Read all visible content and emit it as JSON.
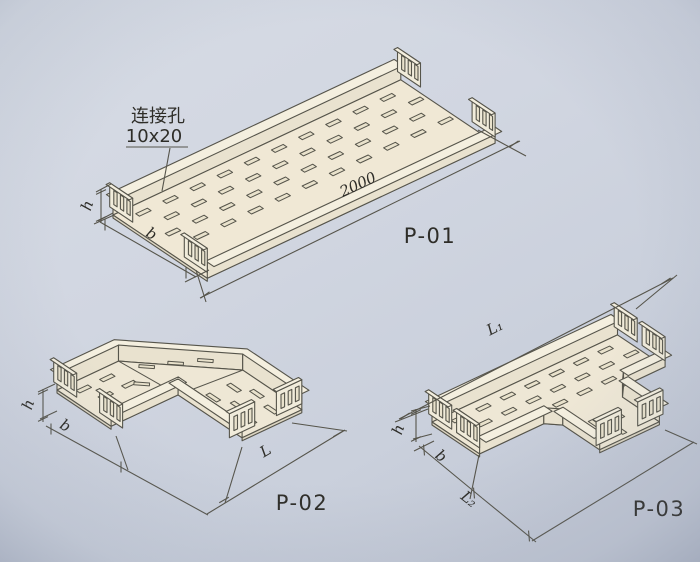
{
  "drawing_type": "cable tray catalog technical drawing",
  "p01": {
    "label": "P-01",
    "note_line1": "连接孔",
    "note_line2": "10x20",
    "dim_h": "h",
    "dim_b": "b",
    "dim_length": "2000"
  },
  "p02": {
    "label": "P-02",
    "dim_h": "h",
    "dim_b": "b",
    "dim_length": "L"
  },
  "p03": {
    "label": "P-03",
    "dim_h": "h",
    "dim_b": "b",
    "dim_l1": "L₁",
    "dim_l2": "L₂"
  },
  "colors": {
    "paper": "#d3d8e2",
    "paper_dark": "#c2c8d6",
    "line": "#56544b",
    "ink": "#2e2d28",
    "tray": "#eee7d5",
    "tray_p01": "#f0e8d5",
    "tray_web": "#e9e2cf",
    "tray_flange": "#f4efdf",
    "tray_plate": "#f1ecdb",
    "tray_edge": "#ddd6c3",
    "slot": "#e9e2cc"
  }
}
